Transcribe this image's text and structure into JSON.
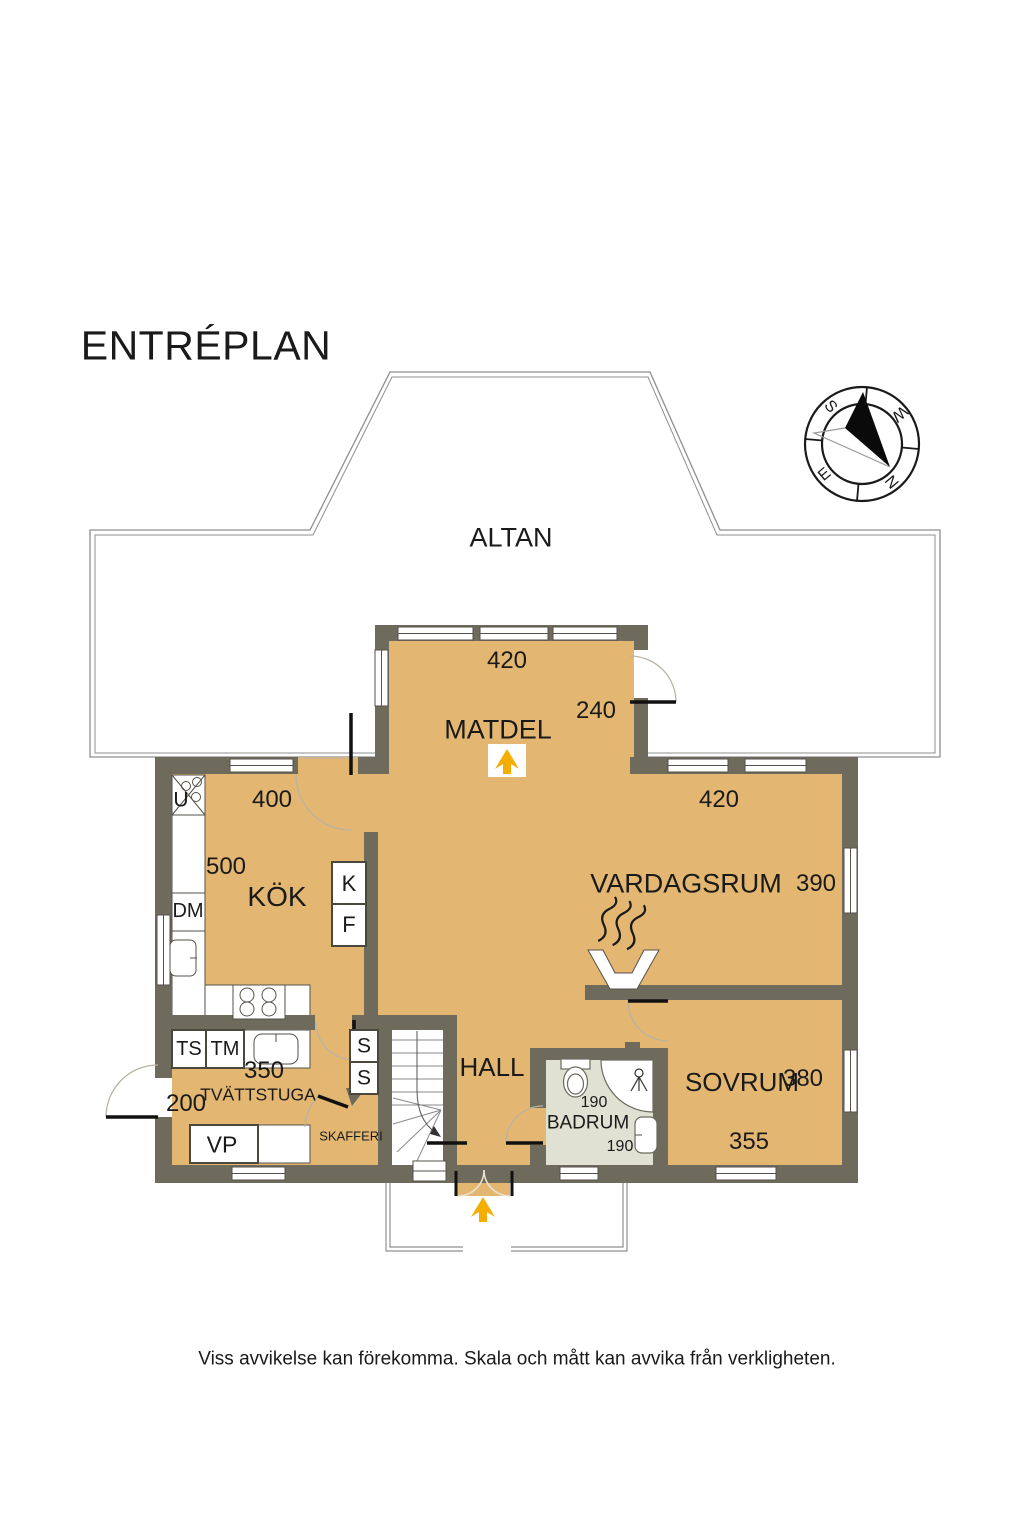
{
  "title": "ENTRÉPLAN",
  "compass": {
    "s": "S",
    "w": "W",
    "e": "E",
    "n": "N"
  },
  "rooms": {
    "altan": "ALTAN",
    "matdel": "MATDEL",
    "kok": "KÖK",
    "vardagsrum": "VARDAGSRUM",
    "hall": "HALL",
    "badrum": "BADRUM",
    "sovrum": "SOVRUM",
    "tvattstuga": "TVÄTTSTUGA",
    "skafferi": "SKAFFERI"
  },
  "dimensions": {
    "matdel_width": "420",
    "matdel_opening": "240",
    "kok_width": "400",
    "kok_depth": "500",
    "vardagsrum_width": "420",
    "vardagsrum_depth": "390",
    "tvattstuga_width": "350",
    "tvattstuga_depth": "200",
    "badrum_width": "190",
    "badrum_depth": "190",
    "sovrum_depth": "380",
    "sovrum_width": "355"
  },
  "fixtures": {
    "oven": "U",
    "dishwasher": "DM",
    "fridge": "K",
    "freezer": "F",
    "drying_cabinet": "TS",
    "washing_machine": "TM",
    "heat_pump": "VP",
    "closet_1": "S",
    "closet_2": "S"
  },
  "disclaimer": "Viss avvikelse kan förekomma. Skala och mått kan avvika från verkligheten.",
  "colors": {
    "floor": "#E3B772",
    "wall": "#6F6B5C",
    "bathroom_floor": "#E1E1D3",
    "arrow": "#F5AD00",
    "outline": "#8F8F8F"
  }
}
